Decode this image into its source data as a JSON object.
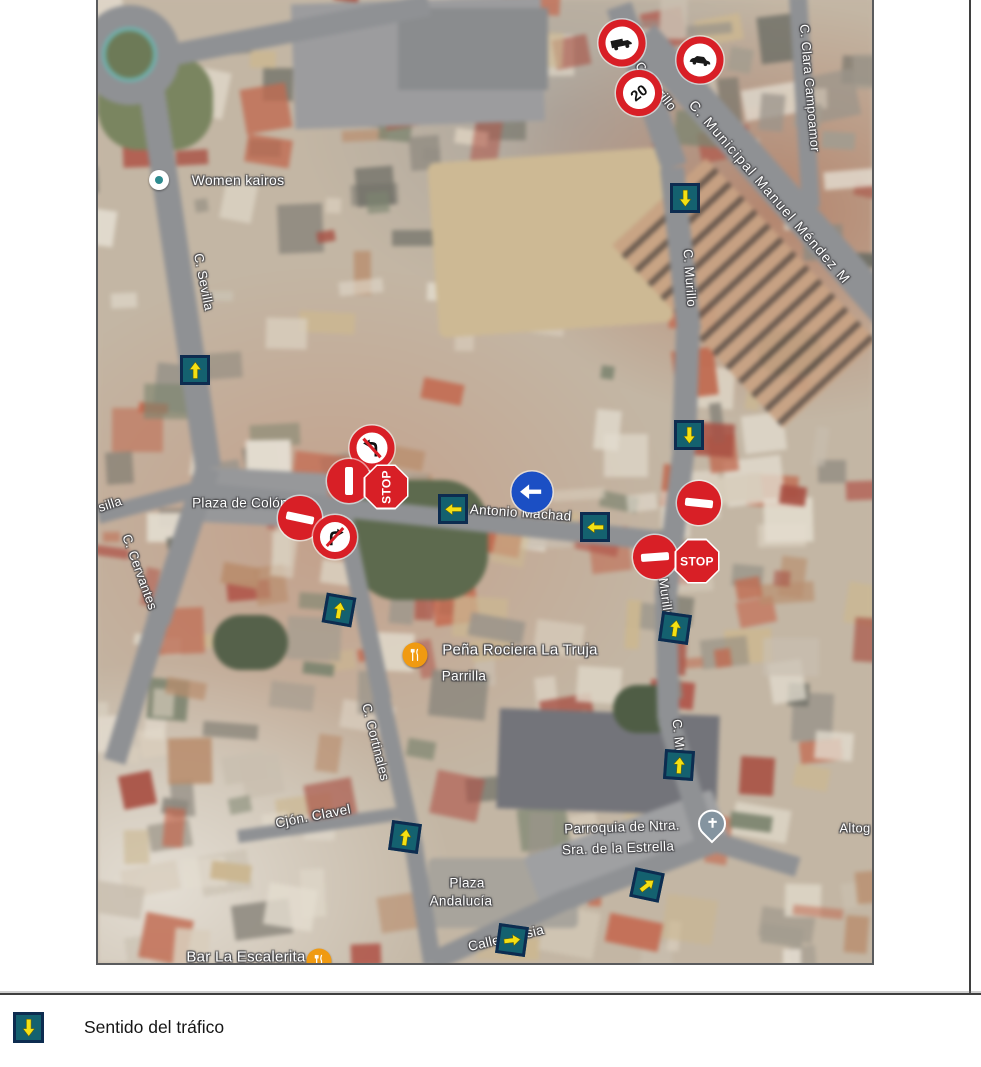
{
  "legend": {
    "label": "Sentido del tráfico",
    "icon": "traffic-direction-arrow-icon",
    "icon_colors": {
      "bg": "#14616f",
      "border": "#0d2c50",
      "arrow": "#f4e013"
    }
  },
  "colors": {
    "sign_red": "#d81f26",
    "sign_blue": "#1b4fc4",
    "arrow_square_bg": "#14616f",
    "arrow_square_border": "#0d2c50",
    "arrow_yellow": "#f4e013",
    "road_gray": "#8f9194",
    "frame": "#3f3f3f"
  },
  "map": {
    "labels": [
      {
        "text": "Women kairos",
        "kind": "place",
        "x": 140,
        "y": 180,
        "rot": 0,
        "size": 14
      },
      {
        "text": "C. Sevilla",
        "kind": "street",
        "x": 106,
        "y": 282,
        "rot": 79,
        "size": 13
      },
      {
        "text": "silla",
        "kind": "street",
        "x": 12,
        "y": 504,
        "rot": -18,
        "size": 13
      },
      {
        "text": "Plaza de Colón",
        "kind": "place",
        "x": 142,
        "y": 503,
        "rot": 0,
        "size": 13.5
      },
      {
        "text": "C. Cervantes",
        "kind": "street",
        "x": 42,
        "y": 572,
        "rot": 70,
        "size": 13
      },
      {
        "text": "C. Murillo",
        "kind": "street",
        "x": 558,
        "y": 86,
        "rot": 52,
        "size": 13
      },
      {
        "text": "C. Murillo",
        "kind": "street",
        "x": 592,
        "y": 278,
        "rot": 86,
        "size": 13
      },
      {
        "text": "Murillo",
        "kind": "street",
        "x": 568,
        "y": 598,
        "rot": 82,
        "size": 13
      },
      {
        "text": "C. Murillo",
        "kind": "street",
        "x": 582,
        "y": 748,
        "rot": 84,
        "size": 13
      },
      {
        "text": "C. Municipal Manuel Méndez M",
        "kind": "street",
        "x": 672,
        "y": 192,
        "rot": 49,
        "size": 14,
        "ls": 1.5
      },
      {
        "text": "C. Clara Campoamor",
        "kind": "street",
        "x": 712,
        "y": 88,
        "rot": 85,
        "size": 13
      },
      {
        "text": "C. Antonio Machad",
        "kind": "street",
        "x": 414,
        "y": 512,
        "rot": 4,
        "size": 13.5
      },
      {
        "text": "Peña Rociera La Truja",
        "kind": "place",
        "x": 422,
        "y": 650,
        "rot": 0,
        "size": 15
      },
      {
        "text": "Parrilla",
        "kind": "place",
        "x": 366,
        "y": 676,
        "rot": 0,
        "size": 13.5
      },
      {
        "text": "C. Cortinales",
        "kind": "street",
        "x": 278,
        "y": 742,
        "rot": 76,
        "size": 13
      },
      {
        "text": "Cjón. Clavel",
        "kind": "street",
        "x": 215,
        "y": 816,
        "rot": -11,
        "size": 13.5
      },
      {
        "text": "Plaza",
        "kind": "place",
        "x": 369,
        "y": 883,
        "rot": 0,
        "size": 13.5
      },
      {
        "text": "Andalucía",
        "kind": "place",
        "x": 363,
        "y": 901,
        "rot": 0,
        "size": 13.5
      },
      {
        "text": "Parroquia de Ntra.",
        "kind": "place",
        "x": 524,
        "y": 827,
        "rot": -2,
        "size": 13.5
      },
      {
        "text": "Sra. de la Estrella",
        "kind": "place",
        "x": 520,
        "y": 848,
        "rot": -2,
        "size": 13.5
      },
      {
        "text": "Calle Iglesia",
        "kind": "street",
        "x": 408,
        "y": 938,
        "rot": -13,
        "size": 13.5
      },
      {
        "text": "Bar La Escalerita",
        "kind": "place",
        "x": 148,
        "y": 957,
        "rot": 0,
        "size": 15
      },
      {
        "text": "Altog",
        "kind": "place",
        "x": 757,
        "y": 828,
        "rot": 0,
        "size": 13
      }
    ],
    "signs": [
      {
        "type": "no-trucks",
        "x": 524,
        "y": 43,
        "rot": -12,
        "size": 47
      },
      {
        "type": "no-motor-vehicles",
        "x": 602,
        "y": 60,
        "rot": 8,
        "size": 47
      },
      {
        "type": "speed-limit-20",
        "text": "20",
        "x": 541,
        "y": 93,
        "rot": -38,
        "size": 46
      },
      {
        "type": "no-left-turn",
        "x": 274,
        "y": 448,
        "rot": 0,
        "size": 45
      },
      {
        "type": "no-entry",
        "x": 251,
        "y": 481,
        "rot": 90,
        "size": 44
      },
      {
        "type": "stop",
        "text": "STOP",
        "x": 288,
        "y": 487,
        "rot": -90,
        "size": 45
      },
      {
        "type": "no-entry",
        "x": 202,
        "y": 518,
        "rot": 12,
        "size": 44
      },
      {
        "type": "no-right-turn",
        "x": 237,
        "y": 537,
        "rot": 0,
        "size": 44
      },
      {
        "type": "mandatory-left",
        "x": 434,
        "y": 492,
        "rot": 0,
        "size": 41
      },
      {
        "type": "no-entry",
        "x": 601,
        "y": 503,
        "rot": 6,
        "size": 44
      },
      {
        "type": "no-entry",
        "x": 557,
        "y": 557,
        "rot": -4,
        "size": 44
      },
      {
        "type": "stop",
        "text": "STOP",
        "x": 599,
        "y": 561,
        "rot": 0,
        "size": 45
      }
    ],
    "arrows": [
      {
        "x": 97,
        "y": 370,
        "dir": 0,
        "tilt": 0
      },
      {
        "x": 587,
        "y": 198,
        "dir": 180,
        "tilt": 0
      },
      {
        "x": 591,
        "y": 435,
        "dir": 180,
        "tilt": 0
      },
      {
        "x": 577,
        "y": 628,
        "dir": 0,
        "tilt": 8
      },
      {
        "x": 581,
        "y": 765,
        "dir": 0,
        "tilt": 4
      },
      {
        "x": 355,
        "y": 509,
        "dir": -90,
        "tilt": 0
      },
      {
        "x": 497,
        "y": 527,
        "dir": -90,
        "tilt": 0
      },
      {
        "x": 241,
        "y": 610,
        "dir": 0,
        "tilt": 10
      },
      {
        "x": 307,
        "y": 837,
        "dir": 0,
        "tilt": 8
      },
      {
        "x": 549,
        "y": 885,
        "dir": 40,
        "tilt": 12
      },
      {
        "x": 414,
        "y": 940,
        "dir": 75,
        "tilt": 8
      }
    ],
    "pins": [
      {
        "kind": "place-dot",
        "x": 61,
        "y": 180
      },
      {
        "kind": "restaurant",
        "x": 317,
        "y": 655
      },
      {
        "kind": "church",
        "x": 614,
        "y": 832
      },
      {
        "kind": "restaurant",
        "x": 221,
        "y": 961
      }
    ]
  }
}
